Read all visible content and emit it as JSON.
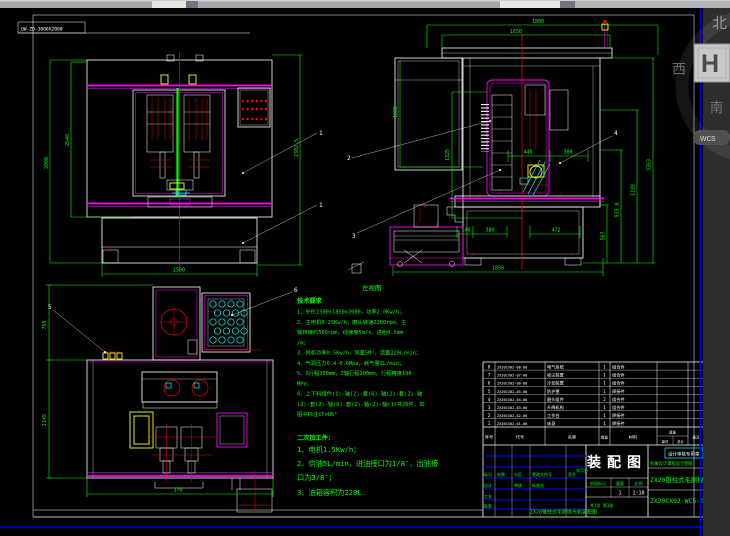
{
  "sheet": {
    "label_box": "QW-ZD-3000X2000"
  },
  "watermark": {
    "char_top": "北",
    "char_west": "西",
    "char_mid": "H",
    "char_bottom": "南",
    "pill": "wcs"
  },
  "views": {
    "front": {
      "balloons": [
        "1",
        "1"
      ],
      "dims": {
        "left_outer": "2000",
        "left_inner": "2548",
        "right": "2302.5",
        "bottom": "1500"
      }
    },
    "side": {
      "caption": "左视图",
      "balloons": [
        "2",
        "3",
        "4"
      ],
      "dims": {
        "top_outer": "1800",
        "top_inner": "1650",
        "left_upper": "1082",
        "left_lower": "1325",
        "mid_a": "440",
        "mid_b": "300",
        "right_a": "567",
        "right_b": "935.8",
        "right_c": "1188",
        "right_d": "3363",
        "bottom_a": "140",
        "bottom_b": "380",
        "bottom_c": "472",
        "bottom_overall": "1850"
      }
    },
    "top": {
      "balloons": [
        "5",
        "6"
      ],
      "dims": {
        "left_upper": "755",
        "left_lower": "1145",
        "bottom": "370"
      }
    }
  },
  "notes_tech": {
    "title": "技术要求",
    "lines": [
      "1、外形1500x1850x2000，功率2.0Kw/h；",
      "2、主电机0.25Kw/h，磨头转速2200rpm，主",
      "轴转速约500rpm，线速度5m/s，进给0.5mm",
      "/m；",
      "3、风机功率0.5Kw/h，风量5M³，流量220L/min；",
      "4、气源压力0.4-0.6Mpa，耗气量2L/min；",
      "5、X行程300mm，Z轴行程200mm，行程精度100",
      "MPa；",
      "6、上下料组件(1)-轴(2)-套(6)-轴(2)-套(2)-轴",
      "(2)-套(2)-轴(6)-套(2)-轴(2)-轴(1)共26件，如",
      "图中标注CT≠86°"
    ]
  },
  "notes_purchase": {
    "title": "二次加工件：",
    "lines": [
      "1、电机1.5Kw/h；",
      "2、供油5L/min，进油接口为1/8″，出油接",
      "口为3/8″；",
      "3、油箱容积为220L."
    ]
  },
  "bom": {
    "headers": {
      "no": "序号",
      "code": "代号",
      "name": "名称",
      "qty": "数量",
      "material": "材料",
      "weight": "重量",
      "unit": "单件",
      "total": "总计",
      "remark": "备注"
    },
    "rows": [
      {
        "no": "8",
        "code": "ZX20CX02-08-00",
        "name": "电气系统",
        "qty": "1",
        "material": "组合件"
      },
      {
        "no": "7",
        "code": "ZX20CX02-07-00",
        "name": "吸尘装置",
        "qty": "1",
        "material": "组合件"
      },
      {
        "no": "6",
        "code": "ZX20CX02-06-00",
        "name": "冷却装置",
        "qty": "1",
        "material": "组合件"
      },
      {
        "no": "5",
        "code": "ZX20CX02-05-00",
        "name": "防护罩",
        "qty": "1",
        "material": "焊接件"
      },
      {
        "no": "4",
        "code": "ZX20CX02-04-00",
        "name": "磨头组件",
        "qty": "2",
        "material": "组合件"
      },
      {
        "no": "3",
        "code": "ZX20CX02-03-00",
        "name": "升降机构",
        "qty": "1",
        "material": "组合件"
      },
      {
        "no": "2",
        "code": "ZX20CX02-02-00",
        "name": "工作台",
        "qty": "1",
        "material": "焊接件"
      },
      {
        "no": "1",
        "code": "ZX20CX02-01-00",
        "name": "床身",
        "qty": "1",
        "material": "焊接件"
      }
    ]
  },
  "title_block": {
    "title": "装配图",
    "stamp": "设计审核专用章",
    "cert_line": "机械设计课程设计图纸",
    "product_name": "ZX20锥柱式毛刷抛光机",
    "drawing_no": "ZX20CX02-WC5-00-00",
    "bottom_caption": "ZX20锥柱式毛刷抛光机装配图",
    "rev_labels": [
      "标记",
      "处数",
      "分区",
      "更改文件号",
      "签名",
      "年月日"
    ],
    "sign_labels": [
      "设计",
      "审核",
      "标准化",
      "工艺",
      "批准"
    ],
    "stage_labels": [
      "阶段标记",
      "重量",
      "比例"
    ],
    "scale": "1:10",
    "weight_value": "1",
    "sheet_info": "共1张 第1张"
  }
}
